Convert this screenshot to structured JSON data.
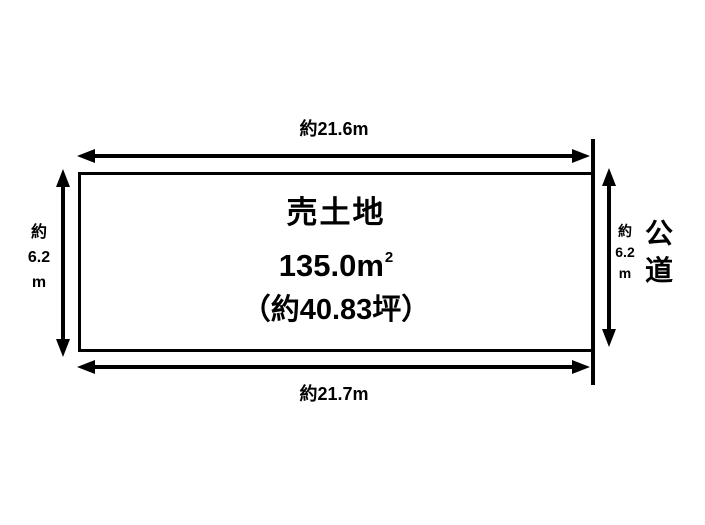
{
  "diagram": {
    "colors": {
      "line": "#000000",
      "background": "#ffffff",
      "text": "#000000"
    },
    "plot": {
      "title": "売土地",
      "area_value": "135.0",
      "area_unit": "m",
      "area_superscript": "2",
      "tsubo": "（約40.83坪）"
    },
    "dimensions": {
      "top": "約21.6m",
      "bottom": "約21.7m",
      "left": [
        "約",
        "6.2",
        "m"
      ],
      "right": [
        "約",
        "6.2",
        "m"
      ]
    },
    "road": [
      "公",
      "道"
    ]
  }
}
